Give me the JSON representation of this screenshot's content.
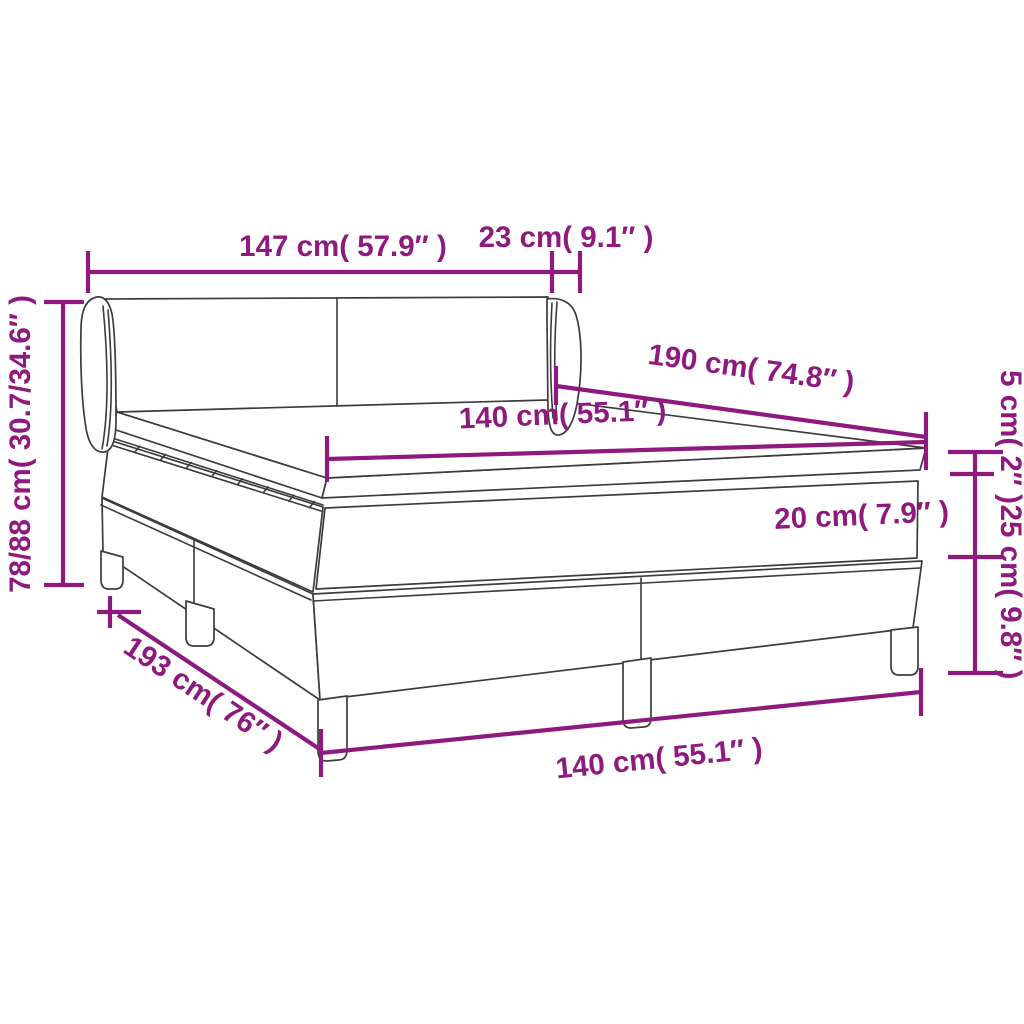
{
  "diagram": {
    "type": "product-dimension-diagram",
    "subject": "box spring bed with winged headboard, mattress and topper",
    "background_color": "#ffffff",
    "colors": {
      "dimension_annotation": "#8E1A7E",
      "line_art": "#3C3C3C"
    },
    "labels": {
      "headboard_width": "147 cm( 57.9″ )",
      "headboard_wing_depth": "23 cm( 9.1″ )",
      "headboard_height": "78/88 cm( 30.7/34.6″ )",
      "mattress_length": "190 cm( 74.8″ )",
      "mattress_width": "140 cm( 55.1″ )",
      "topper_thickness": "5 cm( 2″ )",
      "mattress_thickness": "20 cm( 7.9″ )",
      "base_height": "25 cm( 9.8″ )",
      "base_length": "193 cm( 76″ )",
      "base_width": "140 cm( 55.1″ )"
    }
  }
}
